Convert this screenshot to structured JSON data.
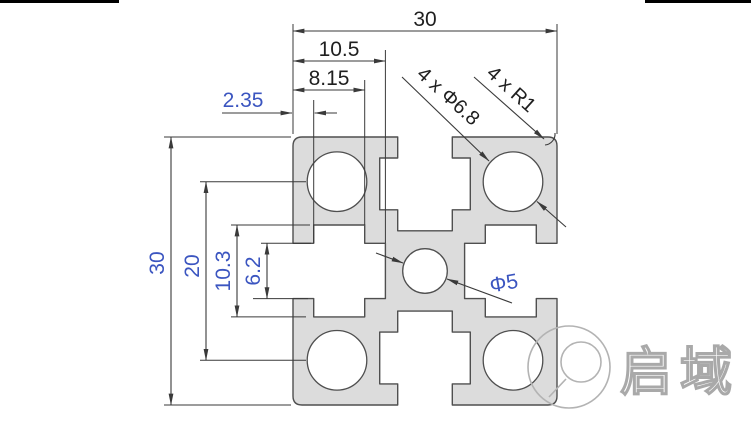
{
  "drawing": {
    "dims": {
      "overall_width": "30",
      "overall_height": "30",
      "slot_depth_total": "10.5",
      "slot_depth_step": "8.15",
      "slot_lip_thickness": "2.35",
      "hole_center_spacing": "20",
      "slot_cavity_width": "10.3",
      "slot_opening_width": "6.2",
      "corner_holes_label": "4 x Φ6.8",
      "corner_radius_label": "4 x R1",
      "center_hole_label": "Φ5"
    },
    "profile_values": {
      "overall_size_mm": 30,
      "corner_hole_diameter_mm": 6.8,
      "corner_hole_count": 4,
      "corner_radius_mm": 1,
      "center_hole_diameter_mm": 5,
      "hole_center_spacing_mm": 20,
      "slot_opening_mm": 6.2,
      "slot_cavity_width_mm": 10.3,
      "slot_lip_mm": 2.35,
      "slot_step_depth_mm": 8.15,
      "slot_total_depth_mm": 10.5
    }
  },
  "watermark": {
    "brand_text": "启域"
  },
  "colors": {
    "dim_text_black": "#1f1f1f",
    "dim_text_blue": "#3b55c0",
    "line": "#3a3a3a",
    "profile_fill": "#dcdcdc",
    "profile_outline": "#4f4f4f",
    "watermark_gray": "#a9a9a9"
  }
}
